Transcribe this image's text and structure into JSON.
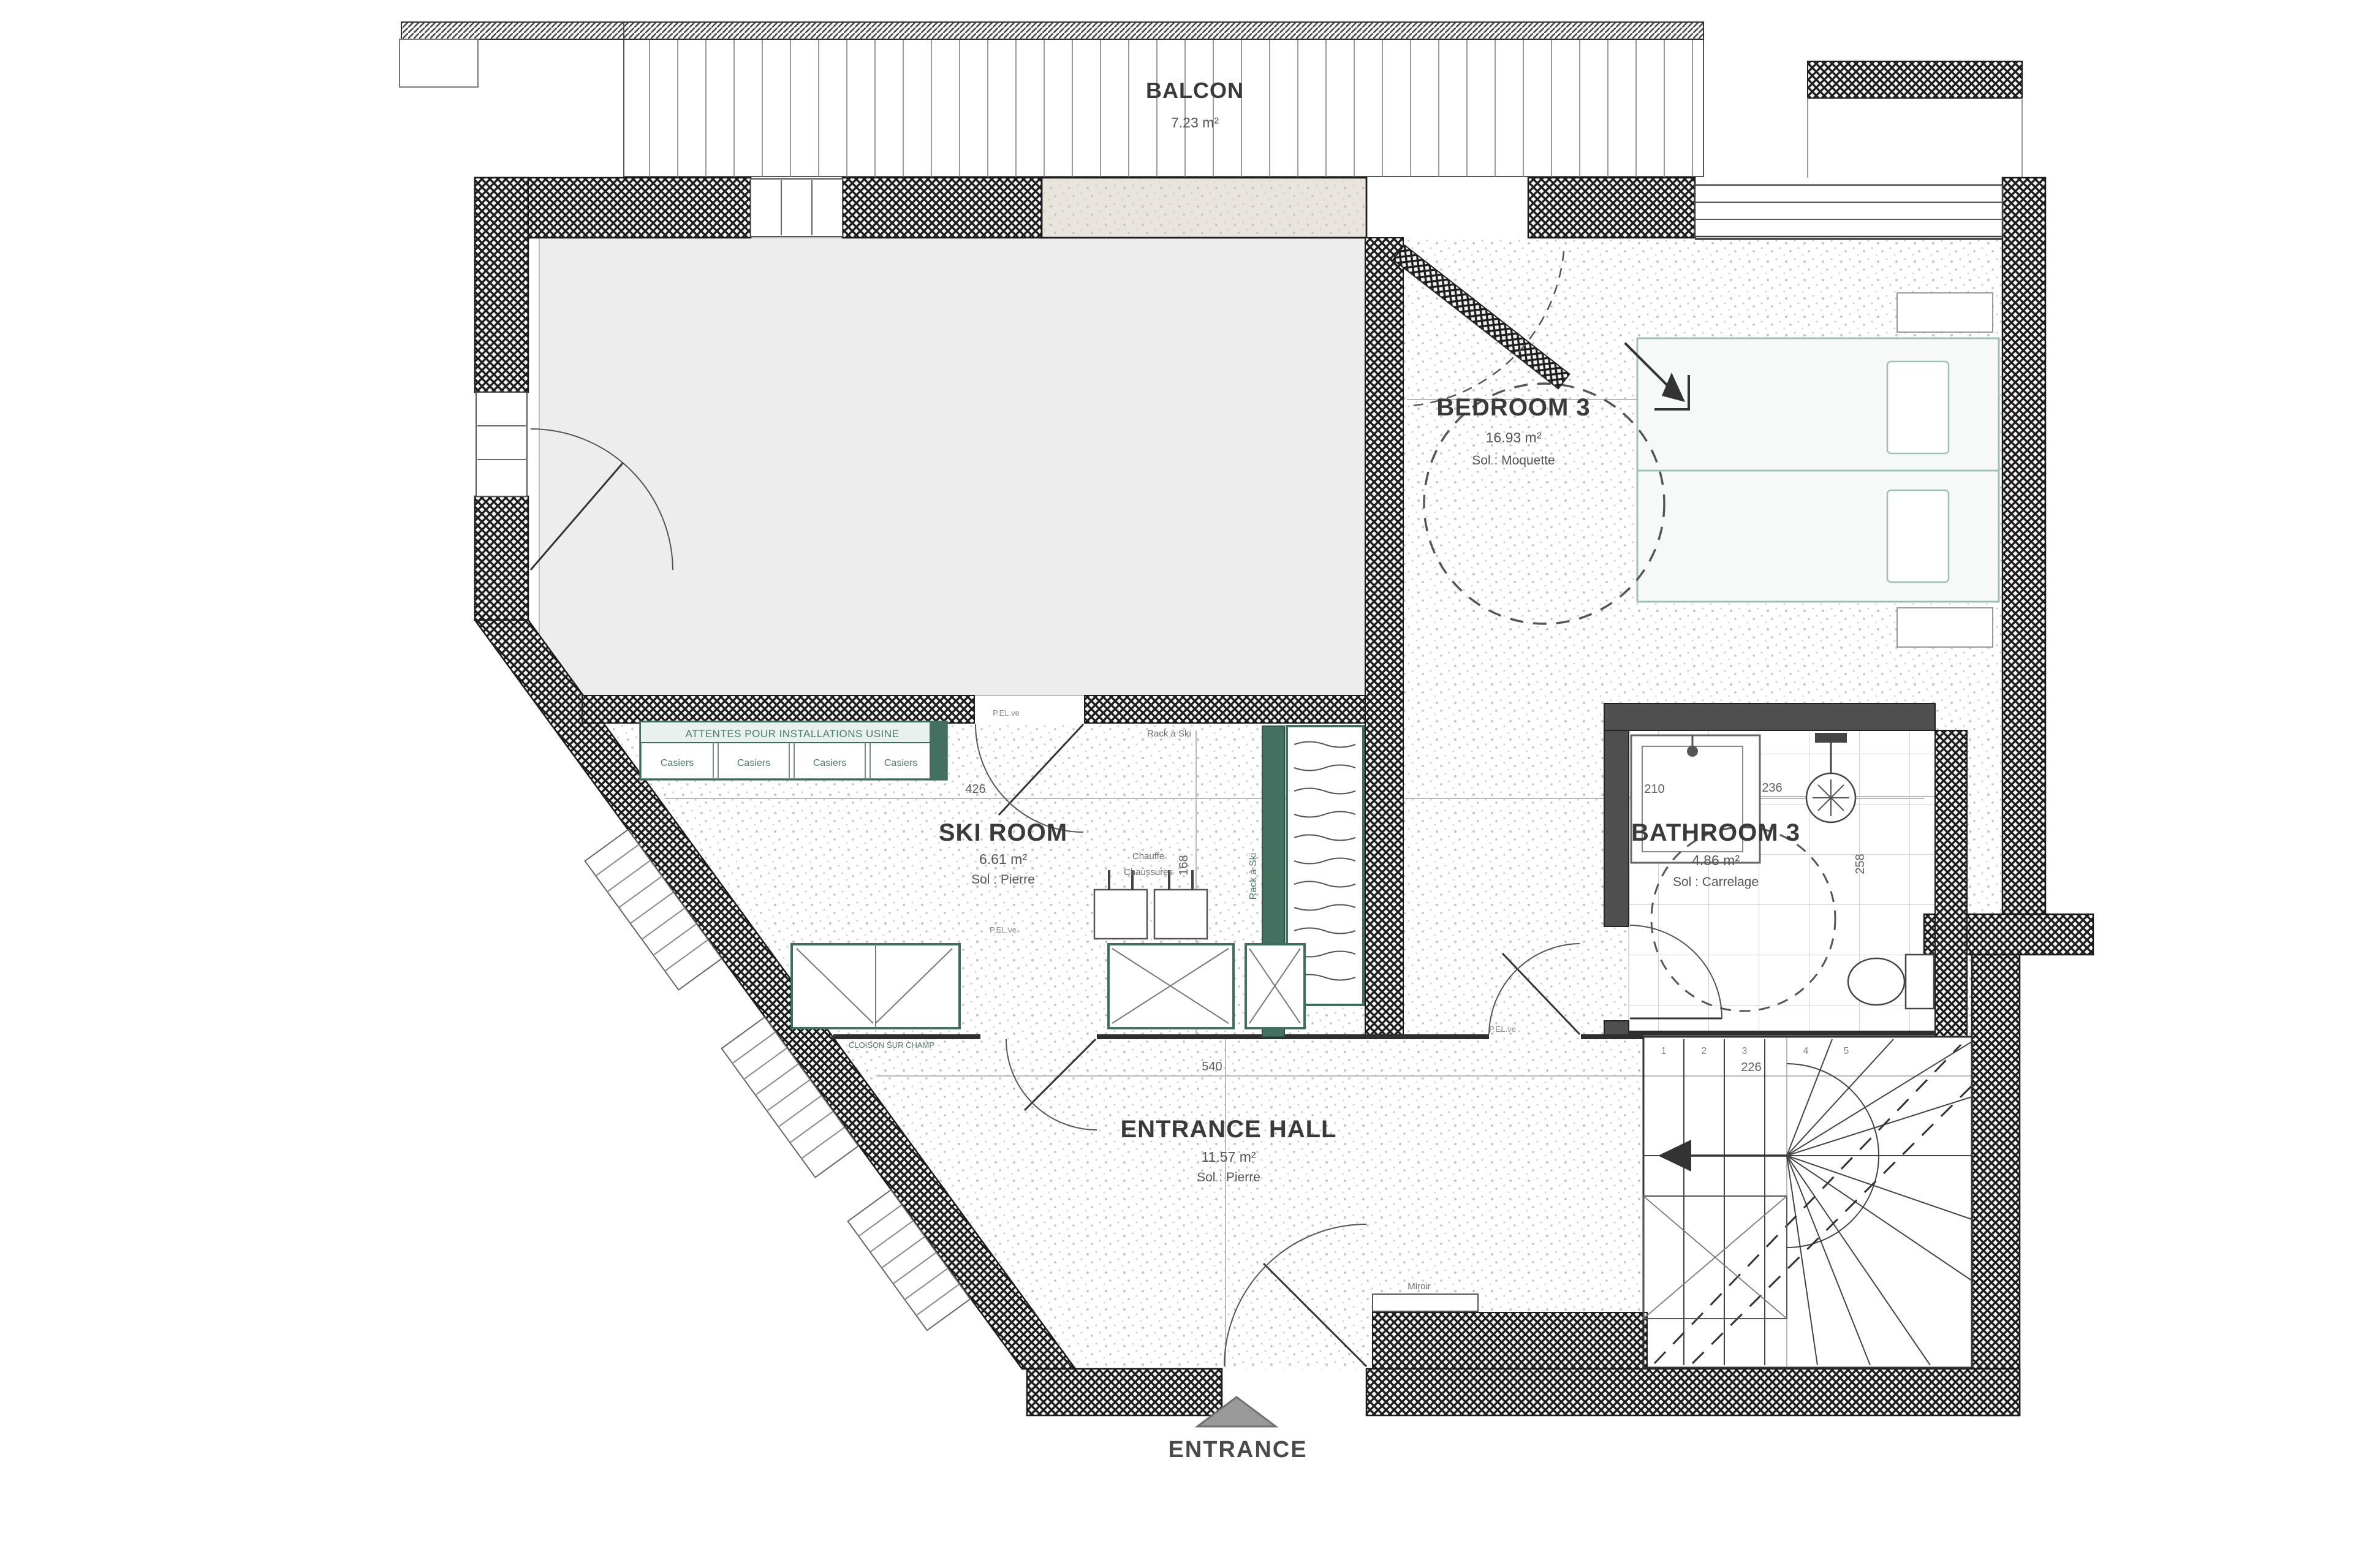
{
  "plan": {
    "rooms": {
      "balcony": {
        "label": "BALCON",
        "area": "7.23 m²"
      },
      "bedroom3": {
        "label": "BEDROOM 3",
        "area": "16.93 m²",
        "floor": "Sol : Moquette"
      },
      "ski_room": {
        "label": "SKI ROOM",
        "area": "6.61 m²",
        "floor": "Sol : Pierre"
      },
      "bathroom3": {
        "label": "BATHROOM 3",
        "area": "4.86 m²",
        "floor": "Sol : Carrelage"
      },
      "entrance_hall": {
        "label": "ENTRANCE HALL",
        "area": "11.57 m²",
        "floor": "Sol : Pierre"
      }
    },
    "entrance": {
      "label": "ENTRANCE"
    },
    "annotations": {
      "attentes": "ATTENTES POUR INSTALLATIONS USINE",
      "casiers": "Casiers",
      "rack_ski": "Rack à Ski",
      "rack_ski_vertical": "Rack à Ski",
      "chauffe_line1": "Chauffe",
      "chauffe_line2": "Chaussures",
      "cloison": "CLOISON SUR CHAMP",
      "miroir": "Miroir",
      "pel": "P.EL.ve"
    },
    "dimensions": {
      "d426": "426",
      "d210": "210",
      "d168": "168",
      "d540": "540",
      "d226": "226",
      "d236": "236",
      "d258": "258"
    },
    "stairs": {
      "steps": [
        "1",
        "2",
        "3",
        "4",
        "5"
      ]
    },
    "colors": {
      "wall": "#1c1c1c",
      "green": "#4a7a68",
      "gray_room": "#ededed",
      "bed": "#9fc0b6",
      "dim_line": "#b9b9b9",
      "triangle": "#9a9a9a"
    }
  }
}
